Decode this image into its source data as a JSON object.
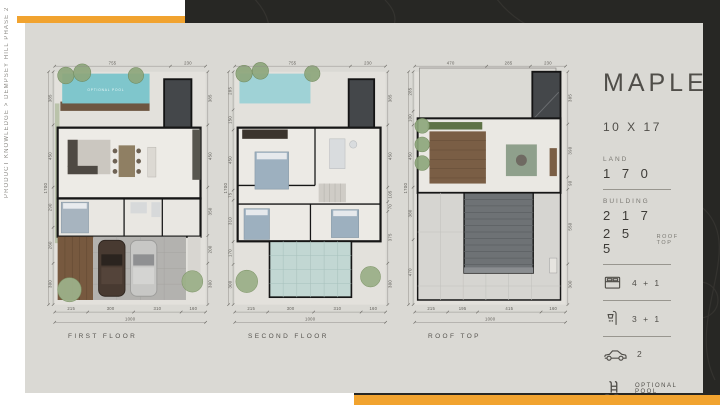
{
  "page": {
    "breadcrumb": "PRODUCT KNOWLEDGE > DEMPSEY HILL PHASE 2"
  },
  "info": {
    "title": "MAPLE",
    "size": "10 X 17",
    "land_label": "LAND",
    "land_value": "1 7 0",
    "building_label": "BUILDING",
    "building_value": "2 1 7",
    "rooftop_value": "2 5 5",
    "rooftop_label": "ROOF TOP",
    "accent_color": "#f1a32f",
    "features": [
      {
        "icon": "bed-icon",
        "label": "4 + 1"
      },
      {
        "icon": "shower-icon",
        "label": "3 + 1"
      },
      {
        "icon": "car-icon",
        "label": "2"
      },
      {
        "icon": "pool-icon",
        "label": "OPTIONAL POOL"
      }
    ]
  },
  "plans": [
    {
      "name": "FIRST FLOOR",
      "pool_label": "OPTIONAL POOL",
      "dims": {
        "top": [
          "755",
          "230"
        ],
        "left_total": "1700",
        "left": [
          "385",
          "450",
          "290",
          "260",
          "300"
        ],
        "right": [
          "385",
          "450",
          "350",
          "200",
          "300"
        ],
        "bottom": [
          "215",
          "300",
          "310",
          "160"
        ],
        "bottom_total": "1000"
      }
    },
    {
      "name": "SECOND FLOOR",
      "dims": {
        "top": [
          "755",
          "230"
        ],
        "left_total": "1700",
        "left": [
          "285",
          "150",
          "450",
          "75",
          "310",
          "170",
          "300"
        ],
        "right": [
          "385",
          "450",
          "105",
          "70",
          "375",
          "300"
        ],
        "bottom": [
          "215",
          "300",
          "310",
          "160"
        ],
        "bottom_total": "1000"
      }
    },
    {
      "name": "ROOF TOP",
      "dims": {
        "top": [
          "470",
          "285",
          "230"
        ],
        "left_total": "1700",
        "left": [
          "285",
          "100",
          "450",
          "380",
          "470"
        ],
        "right": [
          "385",
          "390",
          "90",
          "550",
          "300"
        ],
        "bottom": [
          "215",
          "195",
          "415",
          "160"
        ],
        "bottom_total": "1000"
      }
    }
  ]
}
